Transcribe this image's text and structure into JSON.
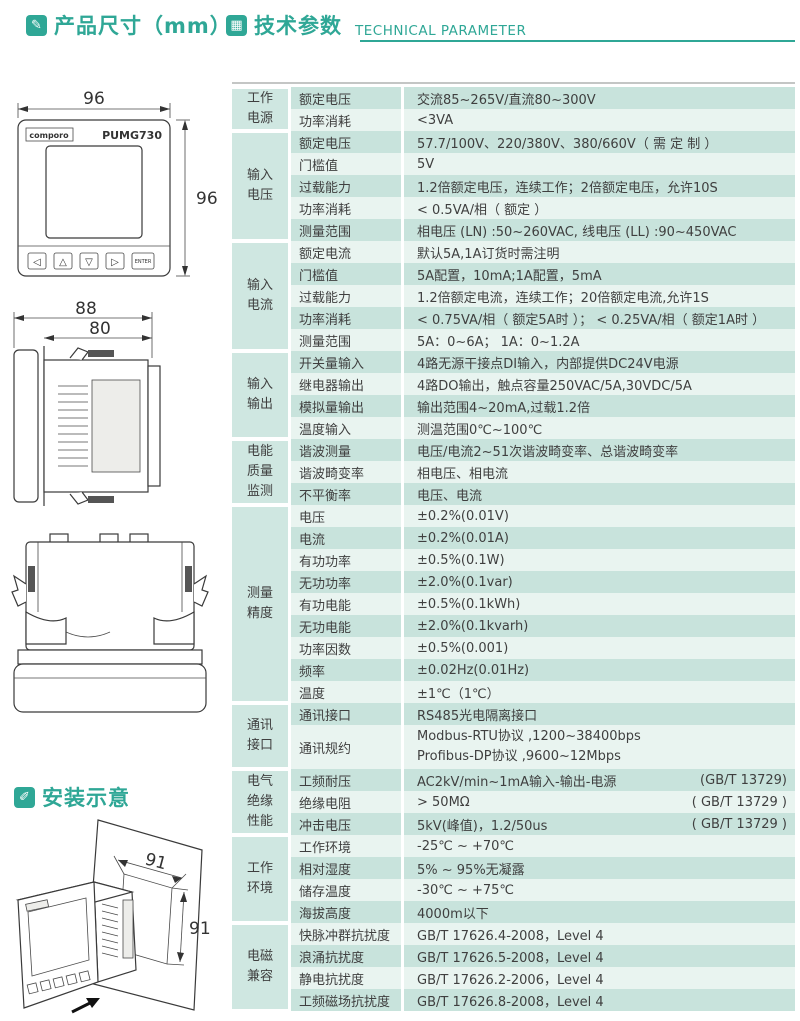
{
  "colors": {
    "accent": "#2fa796",
    "stripe_dark": "#c8e3dc",
    "stripe_light": "#e9f4f0",
    "group_cell": "#cfe7e1"
  },
  "header": {
    "section1_title": "产品尺寸（mm）",
    "section2_title": "技术参数",
    "section2_subtitle": "TECHNICAL PARAMETER",
    "section3_title": "安装示意"
  },
  "device": {
    "brand": "comporo",
    "model": "PUMG730",
    "buttons": [
      "◁",
      "△",
      "▽",
      "▷"
    ],
    "enter_label": "ENTER"
  },
  "dimensions": {
    "front_width": "96",
    "front_height": "96",
    "side_total": "88",
    "side_body": "80",
    "cutout_width": "91",
    "cutout_height": "91"
  },
  "table": {
    "groups": [
      {
        "label": "工作电源",
        "rows": [
          {
            "name": "额定电压",
            "value": "交流85~265V/直流80~300V"
          },
          {
            "name": "功率消耗",
            "value": "<3VA"
          }
        ]
      },
      {
        "label": "输入电压",
        "rows": [
          {
            "name": "额定电压",
            "value": "57.7/100V、220/380V、380/660V（ 需 定 制 ）"
          },
          {
            "name": "门槛值",
            "value": "5V"
          },
          {
            "name": "过载能力",
            "value": "1.2倍额定电压，连续工作；2倍额定电压，允许10S"
          },
          {
            "name": "功率消耗",
            "value": "< 0.5VA/相（ 额定 ）"
          },
          {
            "name": "测量范围",
            "value": "相电压 (LN) :50~260VAC, 线电压 (LL) :90~450VAC"
          }
        ]
      },
      {
        "label": "输入电流",
        "rows": [
          {
            "name": "额定电流",
            "value": "默认5A,1A订货时需注明"
          },
          {
            "name": "门槛值",
            "value": "5A配置，10mA;1A配置，5mA"
          },
          {
            "name": "过载能力",
            "value": "1.2倍额定电流，连续工作；20倍额定电流,允许1S"
          },
          {
            "name": "功率消耗",
            "value": "< 0.75VA/相（ 额定5A时 ）； < 0.25VA/相（ 额定1A时 ）"
          },
          {
            "name": "测量范围",
            "value": "5A：0~6A；  1A：0~1.2A"
          }
        ]
      },
      {
        "label": "输入输出",
        "rows": [
          {
            "name": "开关量输入",
            "value": "4路无源干接点DI输入，内部提供DC24V电源"
          },
          {
            "name": "继电器输出",
            "value": "4路DO输出，触点容量250VAC/5A,30VDC/5A"
          },
          {
            "name": "模拟量输出",
            "value": "输出范围4~20mA,过载1.2倍"
          },
          {
            "name": "温度输入",
            "value": "测温范围0℃~100℃"
          }
        ]
      },
      {
        "label": "电能质量监测",
        "rows": [
          {
            "name": "谐波测量",
            "value": "电压/电流2~51次谐波畸变率、总谐波畸变率"
          },
          {
            "name": "谐波畸变率",
            "value": "相电压、相电流"
          },
          {
            "name": "不平衡率",
            "value": "电压、电流"
          }
        ]
      },
      {
        "label": "测量精度",
        "rows": [
          {
            "name": "电压",
            "value": "±0.2%(0.01V)"
          },
          {
            "name": "电流",
            "value": "±0.2%(0.01A)"
          },
          {
            "name": "有功功率",
            "value": "±0.5%(0.1W)"
          },
          {
            "name": "无功功率",
            "value": "±2.0%(0.1var)"
          },
          {
            "name": "有功电能",
            "value": "±0.5%(0.1kWh)"
          },
          {
            "name": "无功电能",
            "value": "±2.0%(0.1kvarh)"
          },
          {
            "name": "功率因数",
            "value": "±0.5%(0.001)"
          },
          {
            "name": "频率",
            "value": "±0.02Hz(0.01Hz)"
          },
          {
            "name": "温度",
            "value": "±1℃（1℃）"
          }
        ]
      },
      {
        "label": "通讯接口",
        "rows": [
          {
            "name": "通讯接口",
            "value": "RS485光电隔离接口"
          },
          {
            "name": "通讯规约",
            "value": "Modbus-RTU协议 ,1200~38400bps",
            "value2": "Profibus-DP协议 ,9600~12Mbps",
            "tall": true
          }
        ]
      },
      {
        "label": "电气绝缘性能",
        "rows": [
          {
            "name": "工频耐压",
            "value": "AC2kV/min~1mA输入-输出-电源",
            "note": "(GB/T 13729)"
          },
          {
            "name": "绝缘电阻",
            "value": "> 50MΩ",
            "note": "( GB/T 13729 )"
          },
          {
            "name": "冲击电压",
            "value": "5kV(峰值)，1.2/50us",
            "note": "( GB/T 13729 )"
          }
        ]
      },
      {
        "label": "工作环境",
        "rows": [
          {
            "name": "工作环境",
            "value": "-25℃ ~ +70℃"
          },
          {
            "name": "相对湿度",
            "value": "5% ~ 95%无凝露"
          },
          {
            "name": "储存温度",
            "value": "-30℃ ~ +75℃"
          },
          {
            "name": "海拔高度",
            "value": "4000m以下"
          }
        ]
      },
      {
        "label": "电磁兼容",
        "rows": [
          {
            "name": "快脉冲群抗扰度",
            "value": "GB/T 17626.4-2008，Level 4"
          },
          {
            "name": "浪涌抗扰度",
            "value": "GB/T 17626.5-2008，Level 4"
          },
          {
            "name": "静电抗扰度",
            "value": "GB/T 17626.2-2006，Level 4"
          },
          {
            "name": "工频磁场抗扰度",
            "value": "GB/T 17626.8-2008，Level 4"
          }
        ]
      }
    ]
  }
}
